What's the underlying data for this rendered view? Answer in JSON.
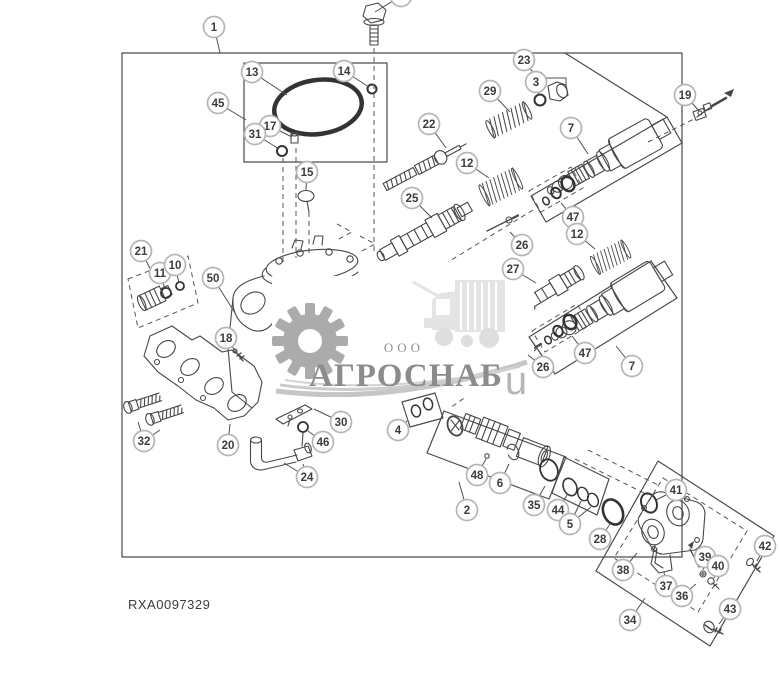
{
  "meta": {
    "part_number": "RXA0097329"
  },
  "watermark": {
    "prefix": "ООО",
    "name": "АГРОСНАБ",
    "suffix": "u",
    "text_color": "#8c8c8c",
    "gear_color": "#ababab",
    "tractor_color": "#e4e4e4"
  },
  "diagram": {
    "line_color": "#474747",
    "callout_fill": "#ffffff",
    "callout_ring": "#b5b5b5",
    "callouts": [
      {
        "n": "",
        "x": 401,
        "y": -4,
        "to": [
          [
            375,
            12
          ]
        ]
      },
      {
        "n": "1",
        "x": 214,
        "y": 27,
        "to": [
          [
            220,
            53
          ]
        ]
      },
      {
        "n": "13",
        "x": 252,
        "y": 72,
        "to": [
          [
            287,
            95
          ]
        ]
      },
      {
        "n": "14",
        "x": 344,
        "y": 71,
        "to": [
          [
            369,
            87
          ]
        ]
      },
      {
        "n": "45",
        "x": 218,
        "y": 103,
        "to": [
          [
            246,
            120
          ]
        ]
      },
      {
        "n": "17",
        "x": 270,
        "y": 126,
        "to": [
          [
            292,
            137
          ]
        ]
      },
      {
        "n": "31",
        "x": 255,
        "y": 134,
        "to": [
          [
            279,
            149
          ]
        ]
      },
      {
        "n": "15",
        "x": 307,
        "y": 172,
        "to": [
          [
            306,
            190
          ]
        ]
      },
      {
        "n": "23",
        "x": 524,
        "y": 60,
        "poly": true,
        "to": [
          [
            537,
            78
          ],
          [
            566,
            78
          ],
          [
            566,
            88
          ]
        ]
      },
      {
        "n": "3",
        "x": 536,
        "y": 82,
        "to": [
          [
            539,
            95
          ]
        ]
      },
      {
        "n": "29",
        "x": 490,
        "y": 91,
        "to": [
          [
            510,
            112
          ]
        ]
      },
      {
        "n": "22",
        "x": 429,
        "y": 124,
        "to": [
          [
            446,
            148
          ]
        ]
      },
      {
        "n": "12",
        "x": 467,
        "y": 163,
        "to": [
          [
            489,
            178
          ]
        ]
      },
      {
        "n": "25",
        "x": 412,
        "y": 198,
        "to": [
          [
            432,
            218
          ]
        ]
      },
      {
        "n": "7",
        "x": 571,
        "y": 128,
        "to": [
          [
            588,
            154
          ]
        ]
      },
      {
        "n": "47",
        "x": 573,
        "y": 217,
        "to": [
          [
            561,
            203
          ]
        ]
      },
      {
        "n": "12",
        "x": 577,
        "y": 234,
        "to": [
          [
            595,
            249
          ]
        ]
      },
      {
        "n": "19",
        "x": 685,
        "y": 95,
        "to": [
          [
            699,
            111
          ]
        ]
      },
      {
        "n": "26",
        "x": 522,
        "y": 245,
        "to": [
          [
            510,
            232
          ]
        ]
      },
      {
        "n": "27",
        "x": 513,
        "y": 269,
        "to": [
          [
            536,
            283
          ]
        ]
      },
      {
        "n": "26",
        "x": 543,
        "y": 367,
        "to": [
          [
            528,
            355
          ]
        ]
      },
      {
        "n": "47",
        "x": 585,
        "y": 353,
        "to": [
          [
            572,
            336
          ]
        ]
      },
      {
        "n": "7",
        "x": 632,
        "y": 366,
        "to": [
          [
            616,
            346
          ]
        ]
      },
      {
        "n": "21",
        "x": 141,
        "y": 251,
        "to": [
          [
            152,
            272
          ]
        ]
      },
      {
        "n": "11",
        "x": 160,
        "y": 273,
        "to": [
          [
            165,
            289
          ]
        ]
      },
      {
        "n": "10",
        "x": 175,
        "y": 265,
        "to": [
          [
            179,
            283
          ]
        ]
      },
      {
        "n": "50",
        "x": 213,
        "y": 278,
        "to": [
          [
            235,
            313
          ]
        ]
      },
      {
        "n": "18",
        "x": 226,
        "y": 338,
        "to": [
          [
            237,
            353
          ]
        ]
      },
      {
        "n": "32",
        "x": 144,
        "y": 441,
        "to": [
          [
            138,
            422
          ],
          [
            160,
            430
          ]
        ]
      },
      {
        "n": "20",
        "x": 228,
        "y": 445,
        "to": [
          [
            230,
            424
          ]
        ]
      },
      {
        "n": "30",
        "x": 341,
        "y": 422,
        "to": [
          [
            314,
            409
          ]
        ]
      },
      {
        "n": "46",
        "x": 323,
        "y": 442,
        "to": [
          [
            308,
            431
          ]
        ]
      },
      {
        "n": "24",
        "x": 307,
        "y": 477,
        "to": [
          [
            284,
            463
          ],
          [
            303,
            464
          ]
        ]
      },
      {
        "n": "4",
        "x": 398,
        "y": 430,
        "to": [
          [
            407,
            421
          ]
        ]
      },
      {
        "n": "2",
        "x": 467,
        "y": 510,
        "to": [
          [
            459,
            482
          ]
        ]
      },
      {
        "n": "48",
        "x": 477,
        "y": 475,
        "to": [
          [
            486,
            459
          ]
        ]
      },
      {
        "n": "6",
        "x": 500,
        "y": 483,
        "to": [
          [
            509,
            464
          ]
        ]
      },
      {
        "n": "35",
        "x": 534,
        "y": 505,
        "to": [
          [
            545,
            486
          ]
        ]
      },
      {
        "n": "44",
        "x": 558,
        "y": 510,
        "to": [
          [
            567,
            495
          ]
        ]
      },
      {
        "n": "5",
        "x": 570,
        "y": 524,
        "to": [
          [
            581,
            501
          ],
          [
            591,
            507
          ]
        ]
      },
      {
        "n": "28",
        "x": 600,
        "y": 539,
        "to": [
          [
            610,
            524
          ]
        ]
      },
      {
        "n": "41",
        "x": 676,
        "y": 490,
        "to": [
          [
            656,
            500
          ]
        ]
      },
      {
        "n": "38",
        "x": 623,
        "y": 570,
        "to": [
          [
            637,
            553
          ]
        ]
      },
      {
        "n": "37",
        "x": 666,
        "y": 586,
        "to": [
          [
            664,
            572
          ]
        ]
      },
      {
        "n": "36",
        "x": 682,
        "y": 596,
        "to": [
          [
            696,
            584
          ]
        ]
      },
      {
        "n": "39",
        "x": 705,
        "y": 557,
        "to": [
          [
            703,
            570
          ]
        ]
      },
      {
        "n": "40",
        "x": 718,
        "y": 566,
        "to": [
          [
            714,
            578
          ]
        ]
      },
      {
        "n": "34",
        "x": 630,
        "y": 620,
        "to": [
          [
            645,
            598
          ]
        ]
      },
      {
        "n": "42",
        "x": 765,
        "y": 546,
        "to": [
          [
            757,
            561
          ]
        ]
      },
      {
        "n": "43",
        "x": 730,
        "y": 609,
        "to": [
          [
            719,
            624
          ]
        ]
      }
    ]
  }
}
